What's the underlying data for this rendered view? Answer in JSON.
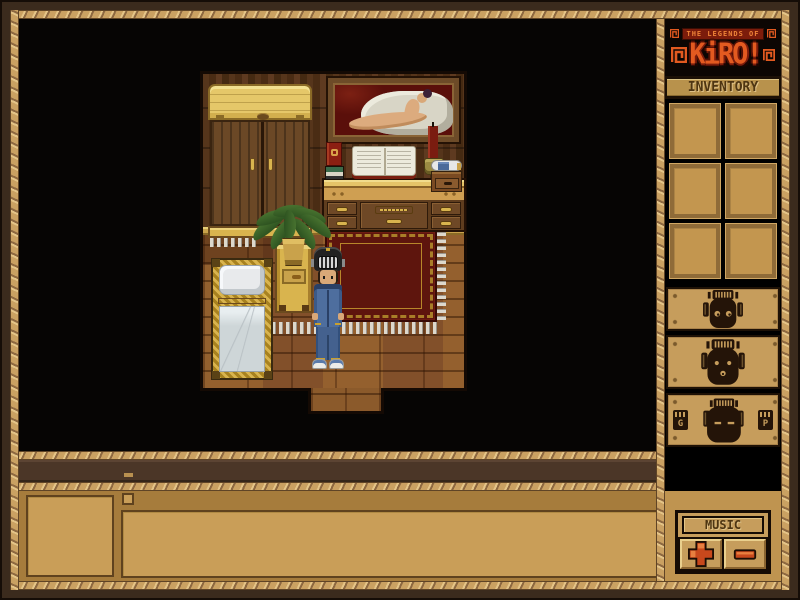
{
  "window": {
    "title": "The Legends of Kiro",
    "width": 800,
    "height": 600
  },
  "logo": {
    "top_text": "THE LEGENDS OF",
    "title": "KiRO!",
    "decoration": "square-spiral-glyphs",
    "accent_color": "#e25a20"
  },
  "sidebar": {
    "inventory_label": "INVENTORY",
    "inventory_slot_count": 6,
    "inventory_slots": [
      "empty",
      "empty",
      "empty",
      "empty",
      "empty",
      "empty"
    ],
    "mask_panels": [
      {
        "icon": "tiki-mask-eyes-open-icon"
      },
      {
        "icon": "tiki-mask-small-eyes-mouth-icon"
      },
      {
        "icon": "tiki-mask-eyes-closed-icon",
        "left_card": "G",
        "right_card": "P"
      }
    ],
    "music": {
      "label": "MUSIC",
      "increase_icon": "plus-icon",
      "decrease_icon": "minus-icon",
      "button_color": "#c8481c"
    }
  },
  "bottom_panel": {
    "portrait": "empty",
    "text_area": "",
    "mini_toggle": "unchecked"
  },
  "scene": {
    "objects": [
      "wardrobe",
      "framed-nude-painting",
      "desk-dresser",
      "red-book",
      "book-stack",
      "open-book",
      "candle",
      "candle-holder",
      "potion-bottle",
      "drawer-box",
      "potted-fern",
      "nightstand",
      "bed",
      "red-rug",
      "player-character",
      "doorway"
    ],
    "character": {
      "outfit": "blue-denim",
      "headgear": "grill-helmet",
      "shoes": "white-sneakers"
    }
  },
  "colors": {
    "frame_wood": "#c9a05e",
    "frame_dark": "#3b2b1d",
    "panel_tan": "#c69d5c",
    "mask_dark": "#241408",
    "rug_red": "#5e150d",
    "denim_blue": "#4e6e9e",
    "button_red": "#c8481c",
    "gold": "#d9b44e"
  }
}
